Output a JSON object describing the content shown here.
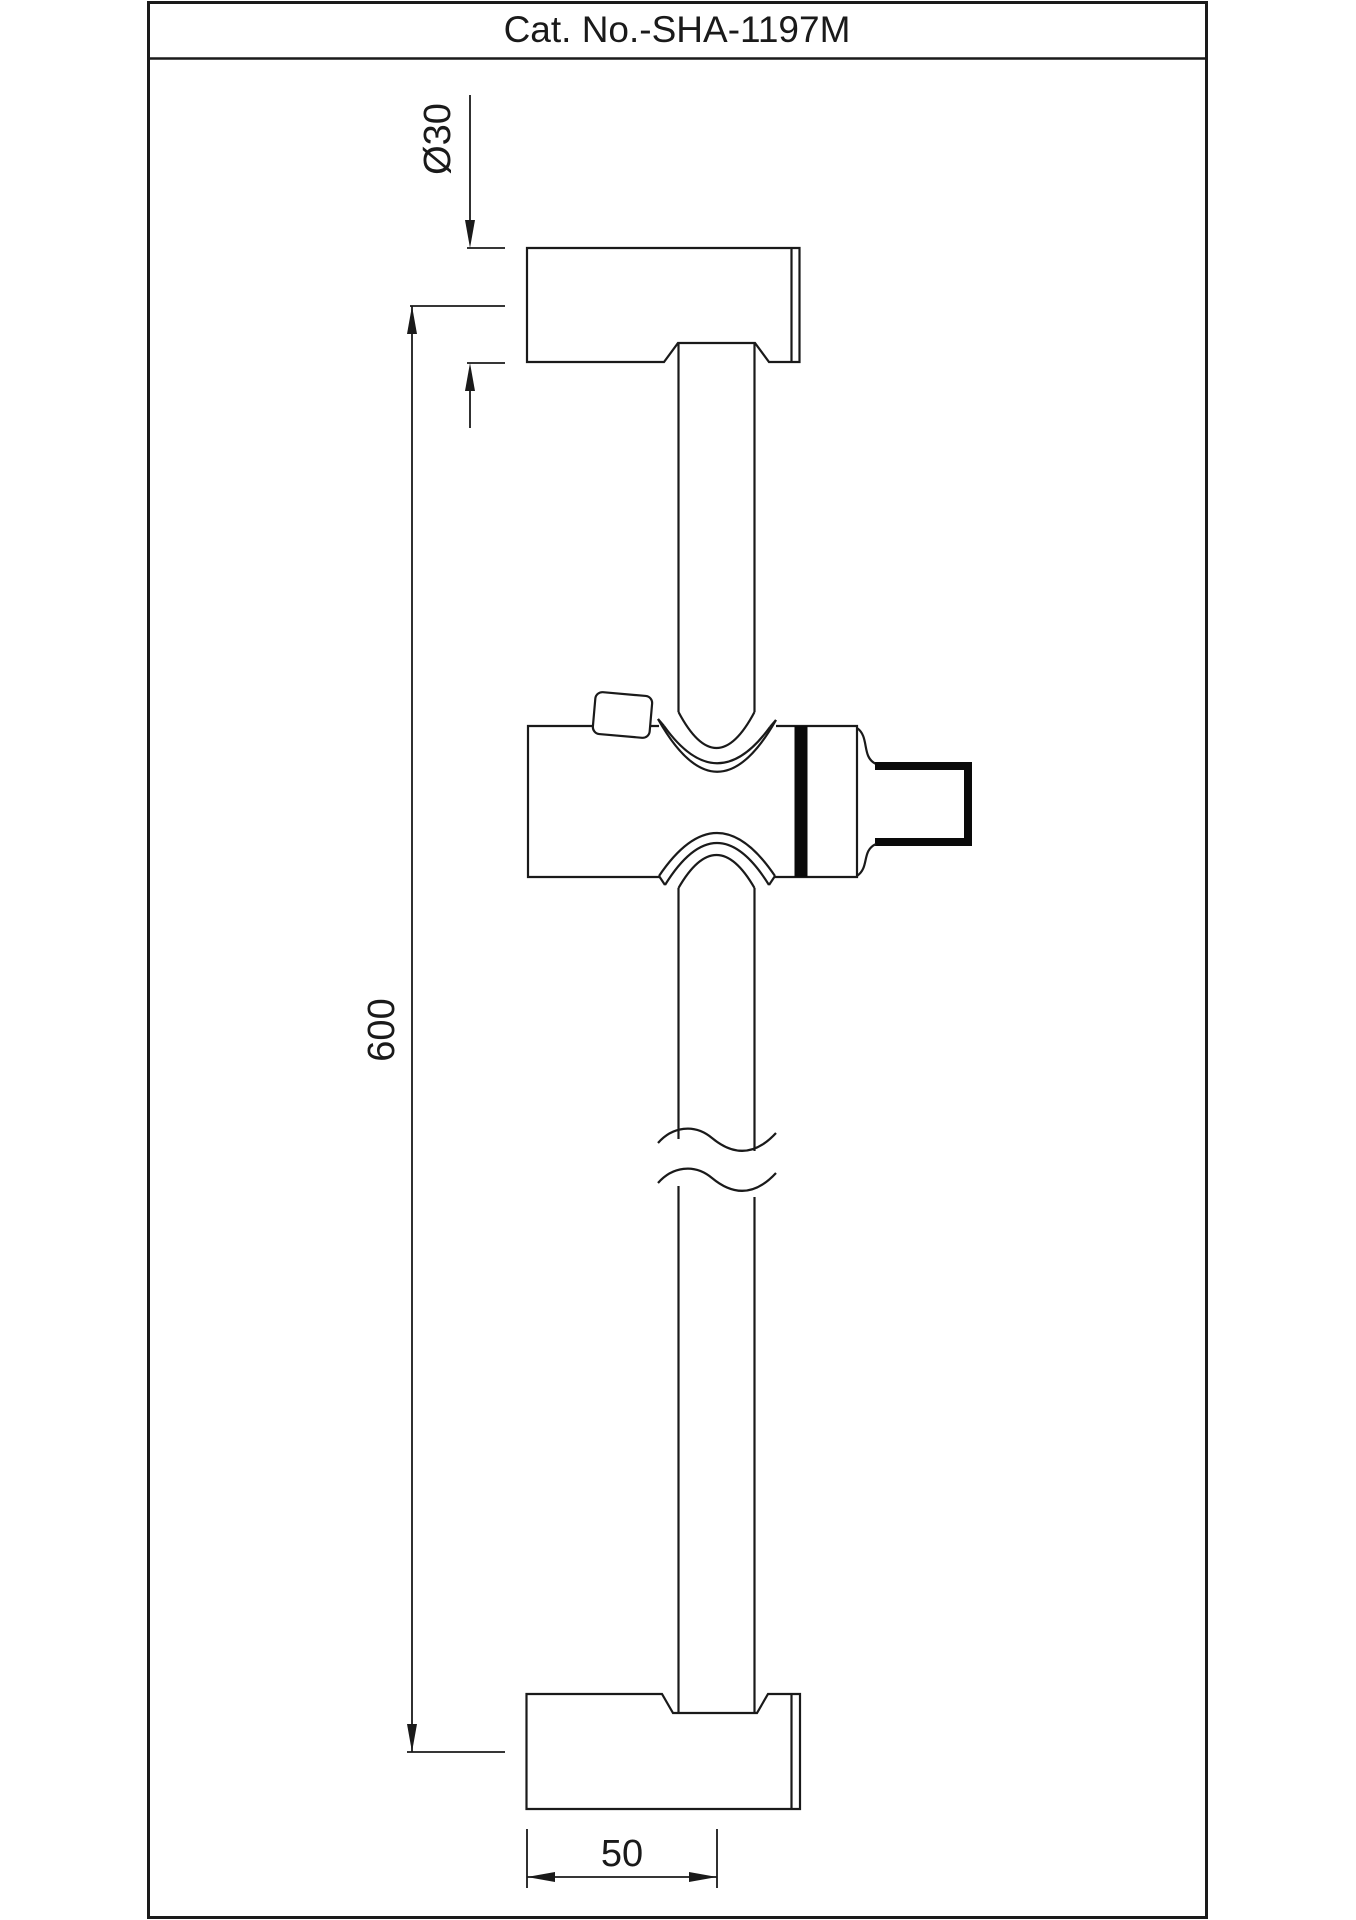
{
  "title_block": {
    "catalog_number": "Cat. No.-SHA-1197M"
  },
  "dimensions": {
    "bracket_diameter": "Ø30",
    "bar_length_center_to_center": "600",
    "wall_to_bar_center": "50"
  },
  "colors": {
    "line": "#1a1a1a",
    "background": "#ffffff",
    "accent_fill": "#0a0a0a"
  }
}
